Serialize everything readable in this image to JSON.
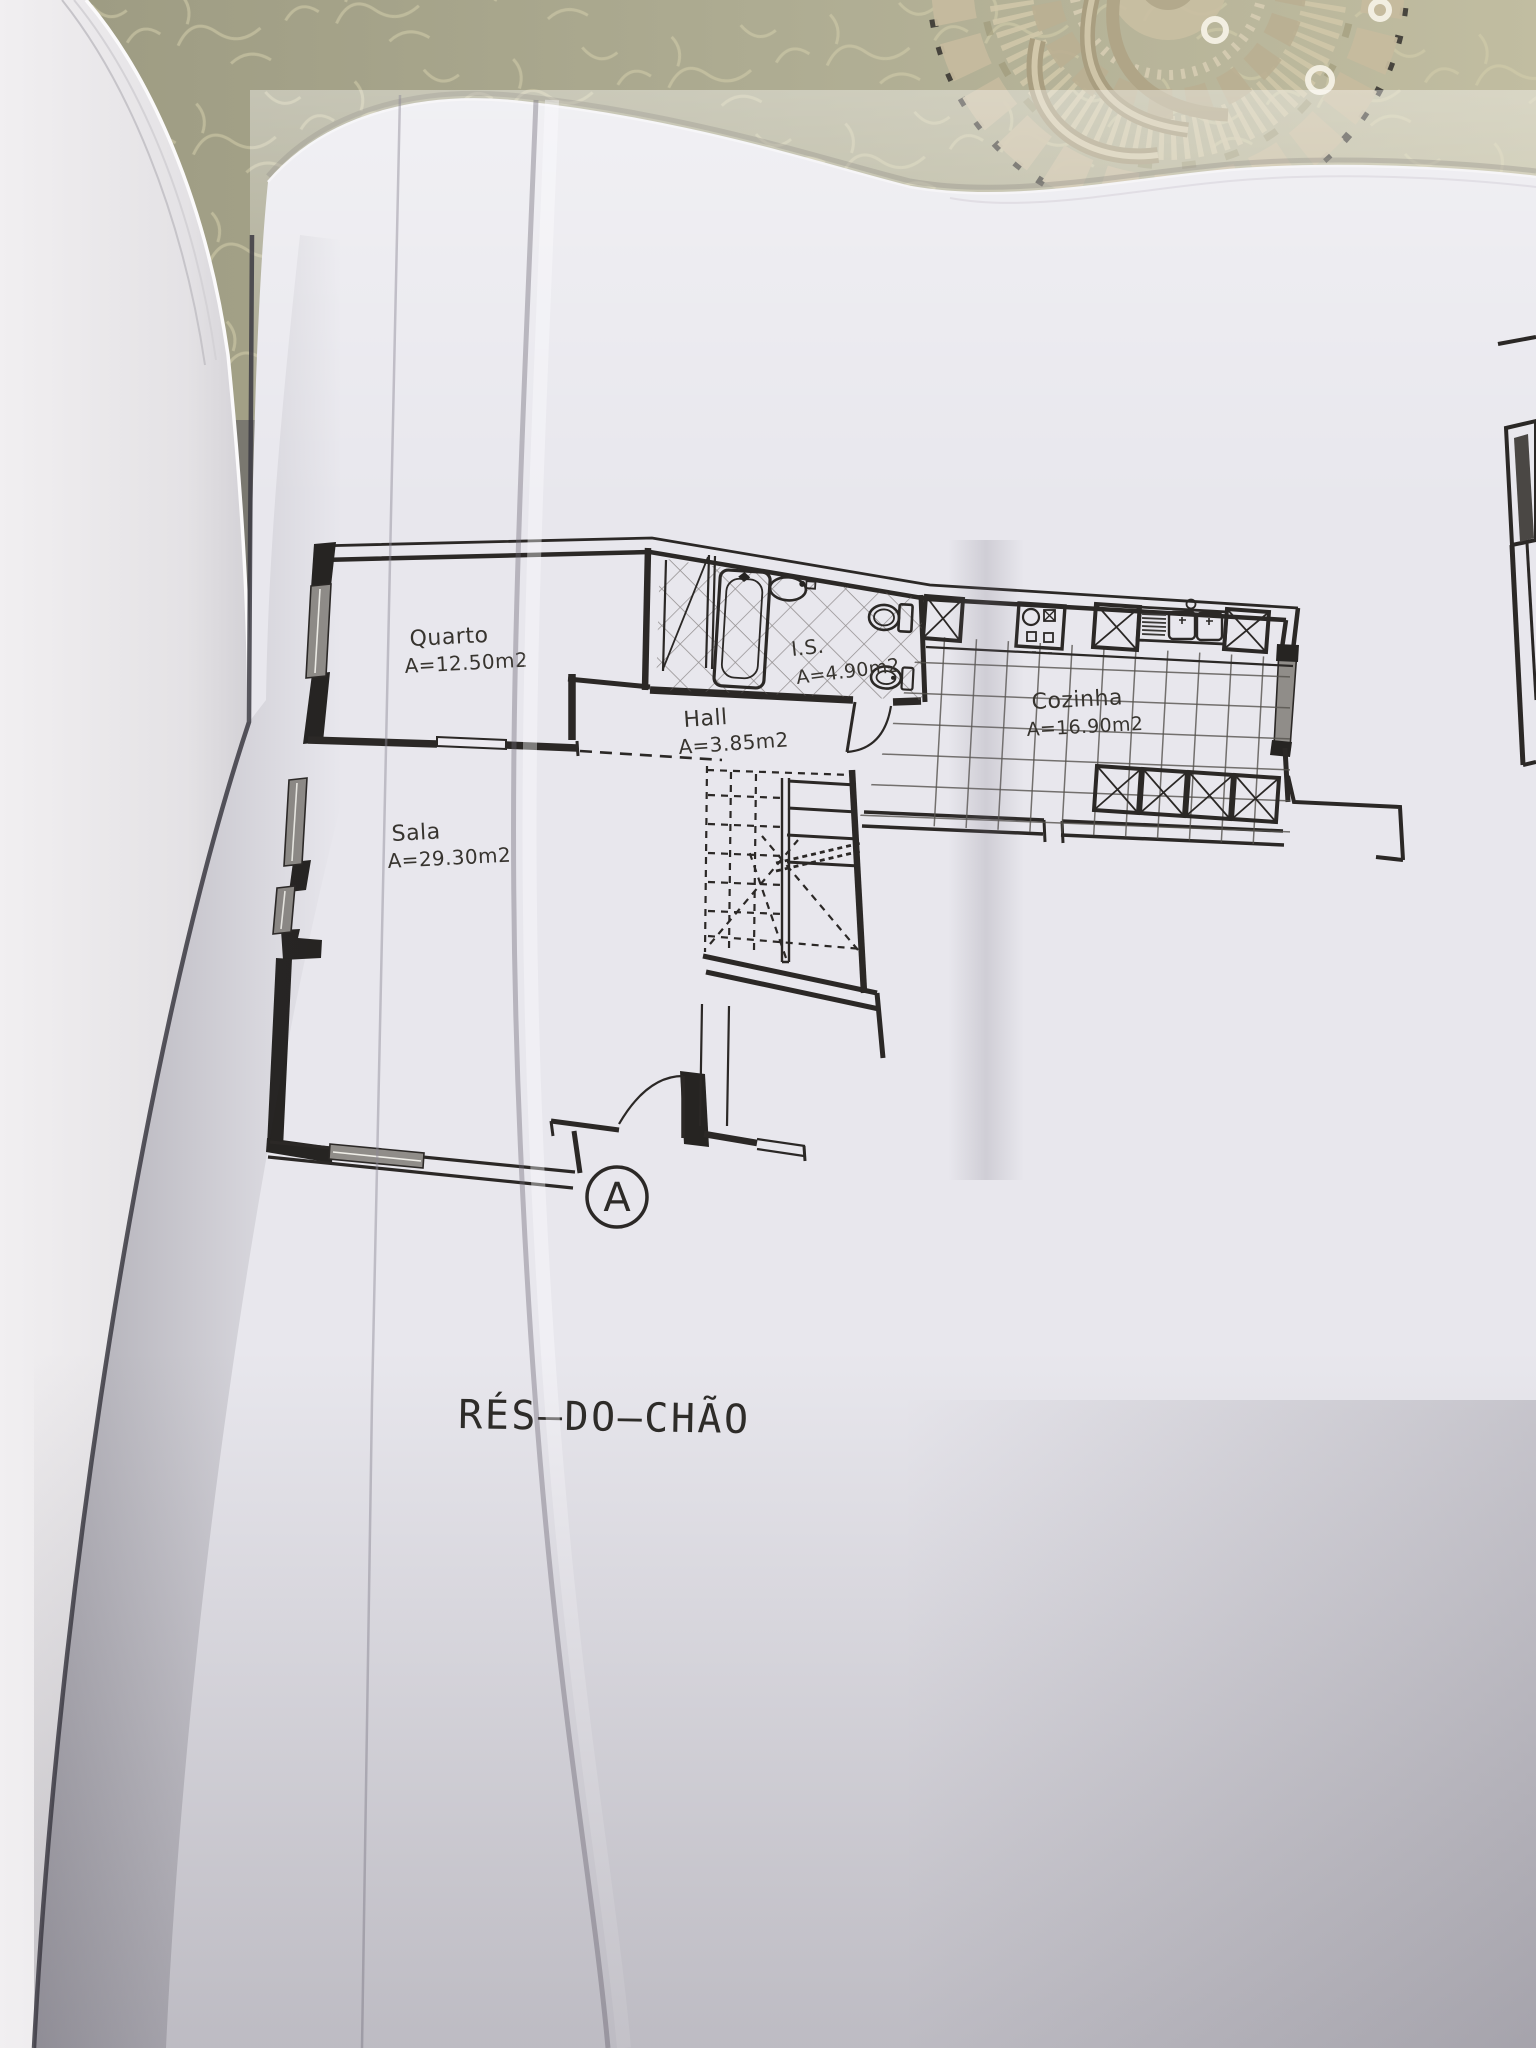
{
  "plan": {
    "title": "RÉS–DO–CHÃO",
    "section_marker": "A",
    "rooms": [
      {
        "name": "Quarto",
        "area": "A=12.50m2"
      },
      {
        "name": "Sala",
        "area": "A=29.30m2"
      },
      {
        "name": "Hall",
        "area": "A=3.85m2"
      },
      {
        "name": "I.S.",
        "area": "A=4.90m2"
      },
      {
        "name": "Cozinha",
        "area": "A=16.90m2"
      }
    ],
    "fixtures": [
      "bathtub",
      "washbasin",
      "toilet",
      "bidet",
      "wardrobe",
      "stove",
      "kitchen-sink",
      "cabinet",
      "stairs",
      "entrance-door",
      "window",
      "duct"
    ],
    "colors": {
      "ink": "#2b2826",
      "paper": "#e8e7ed",
      "left_page": "#eceaec",
      "tablecloth": "#aeac92",
      "lace": "#cbc0a3",
      "window_fill": "#908d89"
    }
  }
}
